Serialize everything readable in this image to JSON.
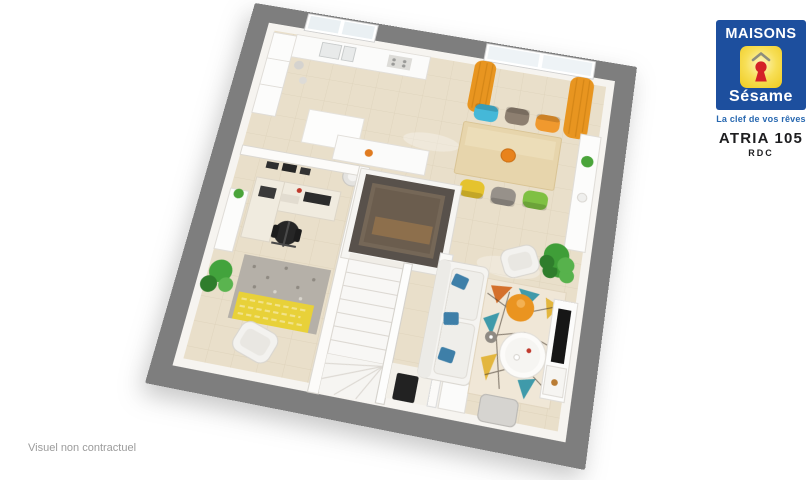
{
  "brand": {
    "name_top": "MAISONS",
    "name_bottom": "Sésame",
    "tagline": "La clef de vos rêves",
    "colors": {
      "blue": "#1d4f9e",
      "yellow": "#f5d22a",
      "keyhole_red": "#d42127"
    }
  },
  "plan": {
    "model": "ATRIA 105",
    "floor": "RDC"
  },
  "footer": {
    "note": "Visuel non contractuel"
  },
  "floorplan": {
    "wall_color": "#7e7e7e",
    "floor_color": "#e9dfca",
    "rooms": [
      "kitchen",
      "dining-area",
      "living-room",
      "office",
      "staircase",
      "storage-room",
      "entrance-hall"
    ],
    "dining_chair_colors": [
      "#45b8d8",
      "#8d7f70",
      "#f0992e",
      "#e5c32e",
      "#97918a",
      "#7fc043"
    ],
    "curtain_color": "#e89520",
    "pouf_color": "#ea9420",
    "sofa_pillow_color": "#3e7fa8",
    "rug_living_colors": [
      "#d4702c",
      "#3f9aaa",
      "#e3b63e"
    ],
    "rug_office_colors": [
      "#b5b0a8",
      "#e8d139"
    ],
    "front_door_color": "#222222"
  }
}
